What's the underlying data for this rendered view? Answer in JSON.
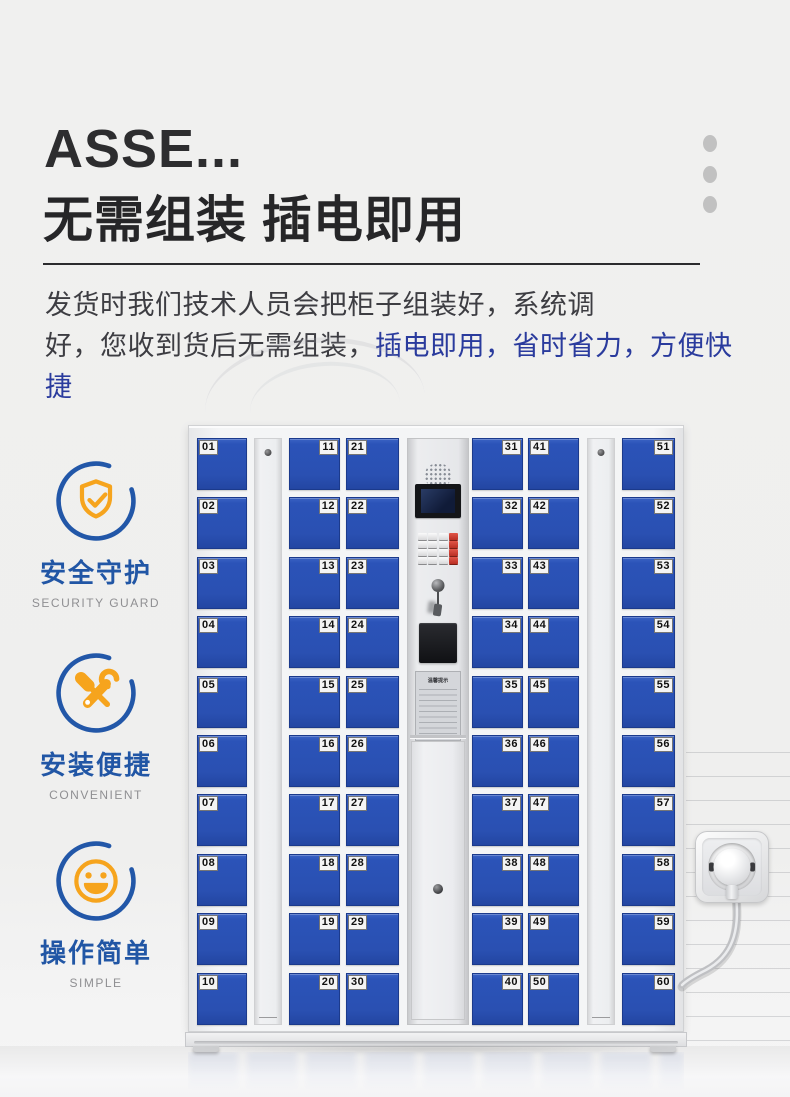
{
  "header": {
    "title_en": "ASSE...",
    "title_zh": "无需组装  插电即用",
    "description": {
      "line1": "发货时我们技术人员会把柜子组装好，系统调",
      "line2_plain": "好，您收到货后无需组装，",
      "line2_highlight": "插电即用，省时省力，方便快捷"
    }
  },
  "features": [
    {
      "icon": "shield-check-icon",
      "title": "安全守护",
      "subtitle": "SECURITY GUARD"
    },
    {
      "icon": "tools-icon",
      "title": "安装便捷",
      "subtitle": "CONVENIENT"
    },
    {
      "icon": "smiley-icon",
      "title": "操作简单",
      "subtitle": "SIMPLE"
    }
  ],
  "locker": {
    "door_columns": [
      {
        "label_side": "left",
        "numbers": [
          "01",
          "02",
          "03",
          "04",
          "05",
          "06",
          "07",
          "08",
          "09",
          "10"
        ]
      },
      {
        "label_side": "right",
        "numbers": [
          "11",
          "12",
          "13",
          "14",
          "15",
          "16",
          "17",
          "18",
          "19",
          "20"
        ]
      },
      {
        "label_side": "left",
        "numbers": [
          "21",
          "22",
          "23",
          "24",
          "25",
          "26",
          "27",
          "28",
          "29",
          "30"
        ]
      },
      {
        "label_side": "right",
        "numbers": [
          "31",
          "32",
          "33",
          "34",
          "35",
          "36",
          "37",
          "38",
          "39",
          "40"
        ]
      },
      {
        "label_side": "left",
        "numbers": [
          "41",
          "42",
          "43",
          "44",
          "45",
          "46",
          "47",
          "48",
          "49",
          "50"
        ]
      },
      {
        "label_side": "right",
        "numbers": [
          "51",
          "52",
          "53",
          "54",
          "55",
          "56",
          "57",
          "58",
          "59",
          "60"
        ]
      }
    ],
    "panel": {
      "notice_title": "温馨提示"
    }
  },
  "colors": {
    "door_blue": "#2b53b8",
    "accent_blue": "#2257a8",
    "accent_orange": "#f6a41d",
    "highlight_text": "#2a3b9d",
    "heading_text": "#2b2b2d"
  }
}
